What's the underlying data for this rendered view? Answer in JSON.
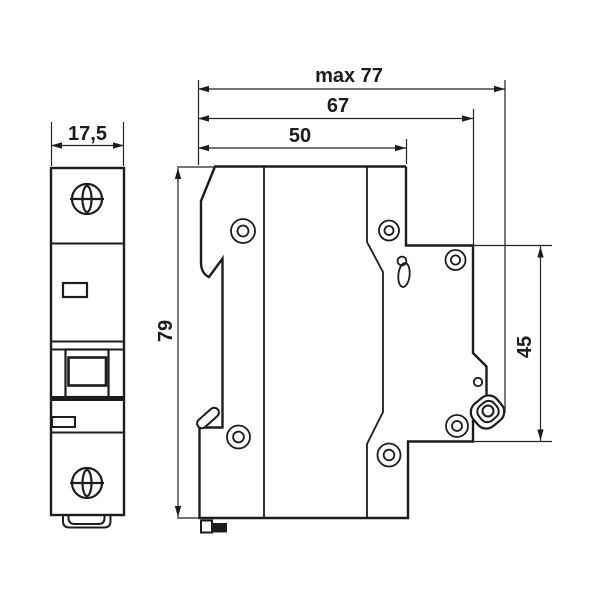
{
  "drawing": {
    "front_view": {
      "width_label": "17,5"
    },
    "side_view": {
      "depth_max_label": "max 77",
      "depth_67_label": "67",
      "depth_50_label": "50",
      "height_label": "79",
      "rail_label": "45"
    },
    "colors": {
      "line": "#1c1c1c",
      "background": "#ffffff"
    }
  }
}
